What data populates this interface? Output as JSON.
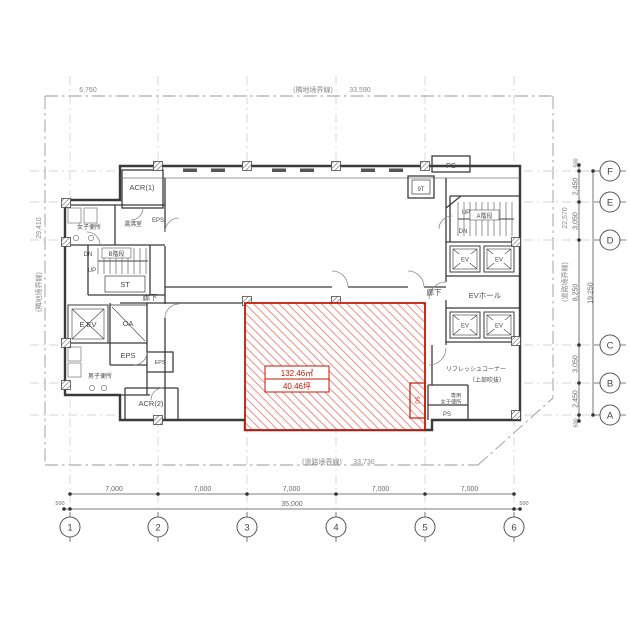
{
  "plan": {
    "boundary": {
      "top": {
        "label": "(隣地境界線)",
        "value": "33,590"
      },
      "left": {
        "label": "(隣地境界線)",
        "value": "29,410"
      },
      "right": {
        "label": "(道路境界線)",
        "value": "22,570"
      },
      "bottom": {
        "label": "(道路境界線)",
        "value": "33,730"
      },
      "offset_top_left": "6,760"
    },
    "grid": {
      "columns": [
        "1",
        "2",
        "3",
        "4",
        "5",
        "6"
      ],
      "rows": [
        "F",
        "E",
        "D",
        "C",
        "B",
        "A"
      ]
    },
    "dimensions": {
      "bottom": {
        "spans": [
          "7,000",
          "7,000",
          "7,000",
          "7,000",
          "7,000"
        ],
        "total": "35,000",
        "edge": "500"
      },
      "right": {
        "spans": [
          "500",
          "2,450",
          "3,050",
          "8,250",
          "3,050",
          "2,450",
          "500"
        ],
        "total": "19,250"
      }
    },
    "rooms": {
      "acr1": "ACR(1)",
      "acr2": "ACR(2)",
      "womens_wc": "女子便所",
      "mens_wc": "男子便所",
      "kitchenette": "湯沸室",
      "stair_b": "B階段",
      "stair_a": "A階段",
      "st": "ST",
      "dn": "DN",
      "up": "UP",
      "corridor": "廊下",
      "em_elevator": "E.EV",
      "oa": "OA",
      "eps": "EPS",
      "ps": "PS",
      "t9": "9T",
      "elevator": "EV",
      "ev_hall": "EVホール",
      "refresh_corner": "リフレッシュコーナー",
      "refresh_note": "（上部吹抜）",
      "exclusive": "専用",
      "exclusive_wc": "女子便所",
      "ds": "DS"
    },
    "tenant": {
      "area_m2": "132.46㎡",
      "area_tsubo": "40.46坪"
    }
  }
}
